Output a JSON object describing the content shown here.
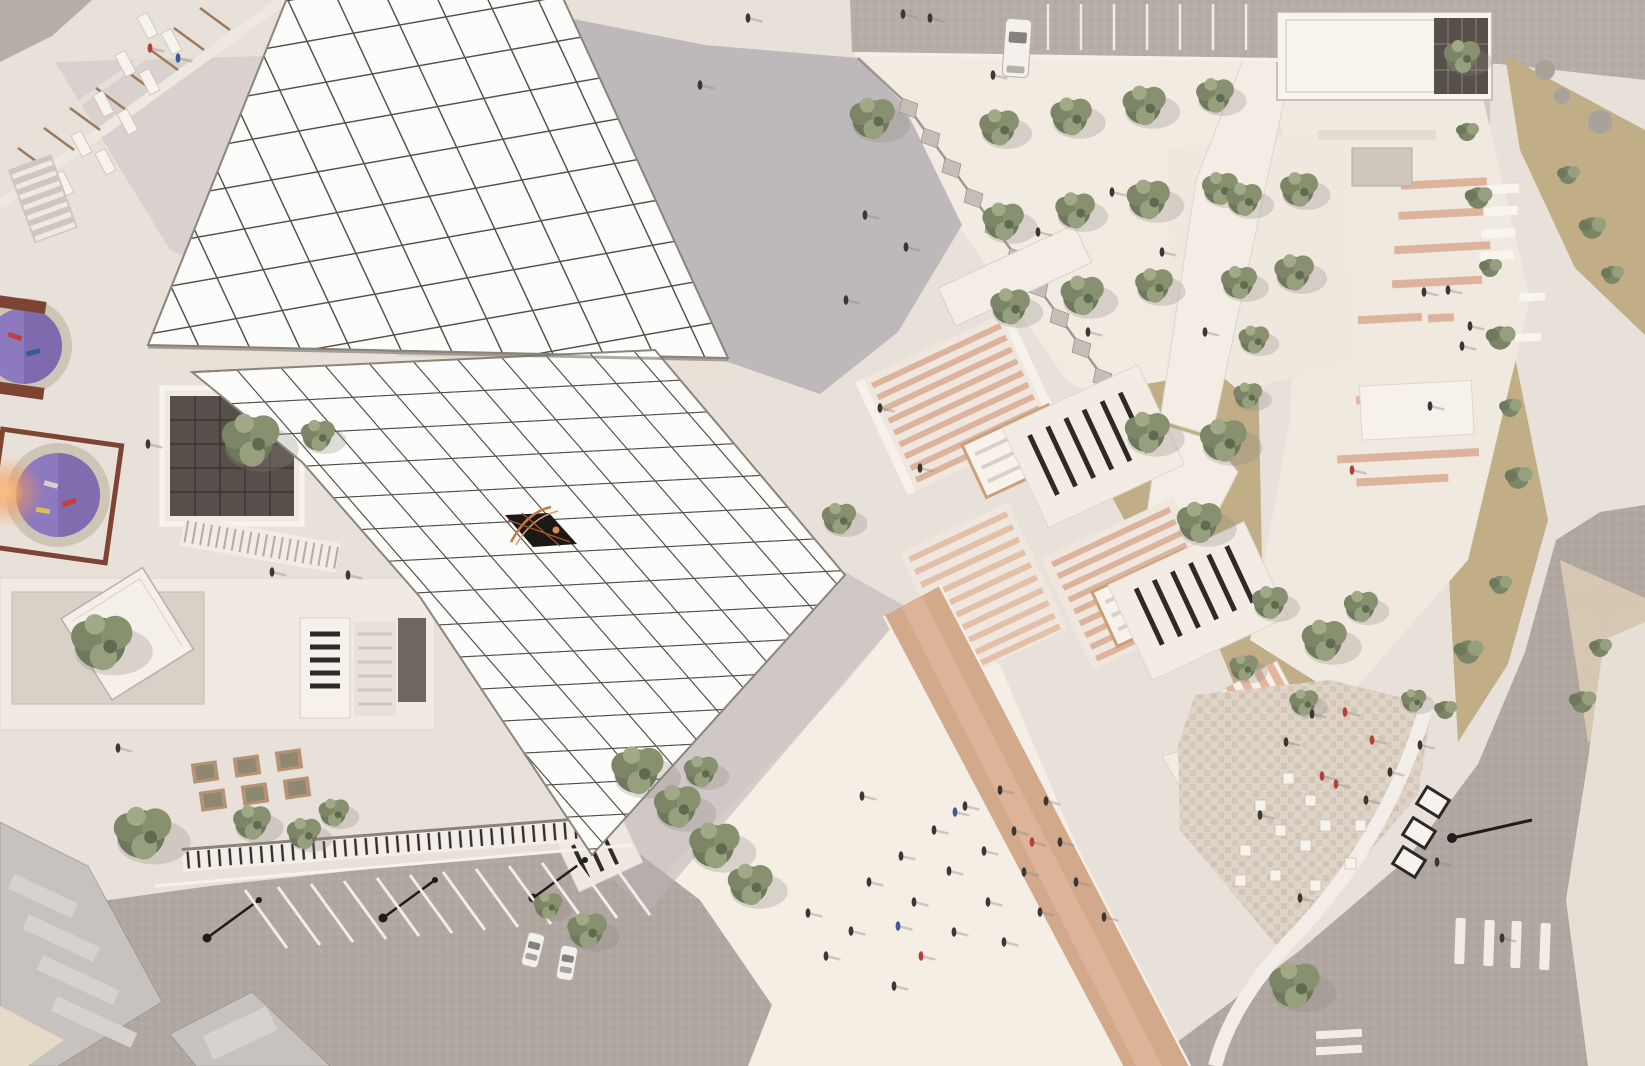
{
  "meta": {
    "title": "Aerial top-down rendering of a museum plaza complex",
    "view": "bird's-eye architectural visualization, no text overlays"
  },
  "palette": {
    "paving_light": "#e8e1d9",
    "paving_bright": "#f4eee5",
    "cobble_road": "#b6ada7",
    "cobble_dark": "#b0a7a1",
    "shadow_gray": "#b9b4b6",
    "roof_panel": "#fcfcfa",
    "roof_grid_line": "#54514c",
    "skylight_dark": "#1b1815",
    "skylight_copper": "#c97a4a",
    "khaki_ground": "#c1ae87",
    "pebble_ground": "#d9cbb2",
    "tree_green_dark": "#6e785c",
    "tree_green_light": "#97a07e",
    "terracotta_stripe": "#dcae94",
    "louver_slit": "#2e2a25",
    "purple_pit": "#8d79bd",
    "stone_ring": "#cfc5b6",
    "frame_brown": "#7e4433",
    "awning_stripe": "#e0ac93",
    "white_structure": "#f7f3ed",
    "glass_dark": "#57504a",
    "lamp_black": "#1f1d1b",
    "car_white": "#f2f0ec",
    "person_dark": "#3b3734",
    "person_red": "#b4403c",
    "person_blue": "#3c5a96",
    "ramp_tan": "#d2a98b"
  },
  "scene": {
    "canopy_roofs": {
      "count": 2,
      "label": "white gridded canopy roofs",
      "skylight": "dark glass opening with copper ribs"
    },
    "stairs": {
      "label": "sunken terracotta-striped grand stairs",
      "flights": 3
    },
    "vegetation": {
      "olive_trees": 40,
      "shrubs": 14
    },
    "people": {
      "approx_count": 55
    },
    "transport": {
      "cars": 2,
      "van": 1,
      "parking_stripes": 12,
      "top_parking_lines": 7,
      "crosswalk_bars": 4
    },
    "amenities": {
      "purple_play_pits": 2,
      "sun_loungers": 9,
      "tree_planters": 6,
      "seat_cubes": 12,
      "signboards": 3,
      "street_lamps": 4
    }
  }
}
